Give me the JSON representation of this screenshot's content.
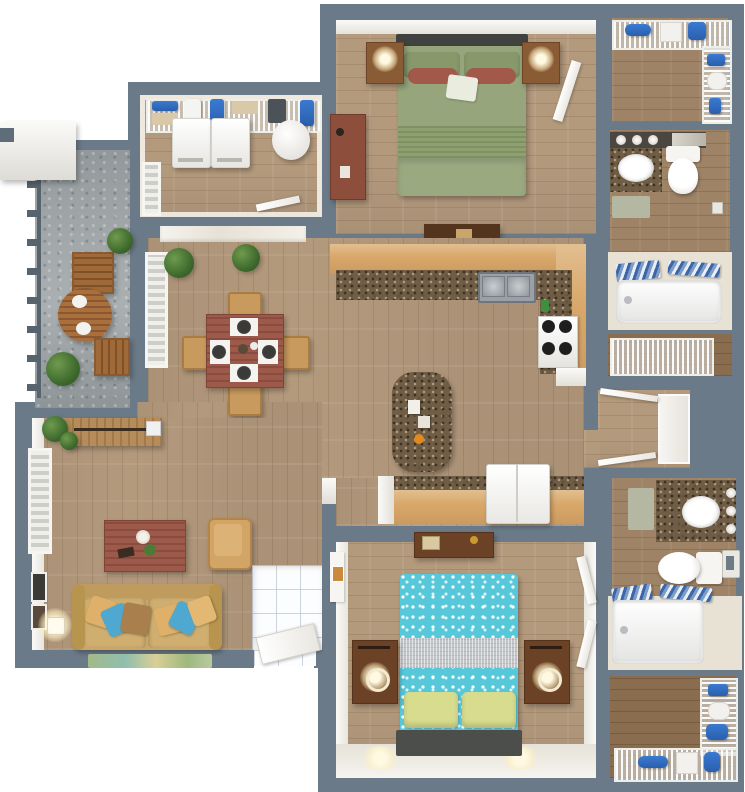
{
  "title": "3D top-down floor plan of a two-bedroom, two-bathroom apartment with patio",
  "palette": {
    "wall_gray": "#6b7a88",
    "wood_floor": "#b49a7d",
    "dark_wood_floor": "#9e8366",
    "closet_floor": "#8a6d4f",
    "patio_concrete": "#9fa5a7",
    "kitchen_cabinet": "#d9a96c",
    "granite_counter": "#6f5d45",
    "white_wall": "#f3f1ec",
    "bed1_green": "#95a47a",
    "bed2_teal": "#57c7da",
    "bed2_pillow_yellow": "#d8dc8e",
    "sofa_tan": "#c9a768",
    "table_redwood": "#9d5a4a",
    "towel_blue": "#2f6fc1"
  },
  "rooms": [
    {
      "name": "Patio",
      "furniture": [
        "round wood table",
        "wood bench",
        "wood stool",
        "bushes",
        "railing"
      ]
    },
    {
      "name": "Laundry room",
      "furniture": [
        "washer",
        "dryer",
        "round hamper",
        "wire shelf with towels and baskets"
      ]
    },
    {
      "name": "Bedroom 1",
      "furniture": [
        "queen bed with green bedding",
        "two nightstands with lamps",
        "dresser",
        "media bench"
      ]
    },
    {
      "name": "Closet 1",
      "furniture": [
        "wire shelving",
        "blue towels",
        "baskets"
      ]
    },
    {
      "name": "Bathroom 1",
      "furniture": [
        "vanity with sink",
        "toilet",
        "bath mat",
        "bathtub",
        "striped towels"
      ]
    },
    {
      "name": "Linen closet",
      "furniture": [
        "wire shelving"
      ]
    },
    {
      "name": "Dining area",
      "furniture": [
        "square table with four place settings",
        "four chairs",
        "potted plants",
        "shuttered windows"
      ]
    },
    {
      "name": "Kitchen",
      "furniture": [
        "L-shaped counter",
        "double sink",
        "stove",
        "granite island",
        "refrigerator",
        "lower counter"
      ]
    },
    {
      "name": "Hallway",
      "furniture": [
        "closet doors"
      ]
    },
    {
      "name": "Living room",
      "furniture": [
        "console table",
        "coffee table",
        "armchair",
        "sofa with pillows",
        "floor lamp",
        "rug",
        "shuttered window",
        "wall art"
      ]
    },
    {
      "name": "Entry",
      "furniture": [
        "white tile floor",
        "front door"
      ]
    },
    {
      "name": "Bedroom 2",
      "furniture": [
        "queen bed with teal polka-dot bedding",
        "yellow pillows",
        "two nightstands with lamps",
        "dresser"
      ]
    },
    {
      "name": "Bathroom 2",
      "furniture": [
        "vanity with sink",
        "toilet",
        "bath mat",
        "bathtub",
        "striped towels",
        "towel ring"
      ]
    },
    {
      "name": "Walk-in closet",
      "furniture": [
        "wire shelving",
        "blue towels",
        "baskets"
      ]
    }
  ]
}
